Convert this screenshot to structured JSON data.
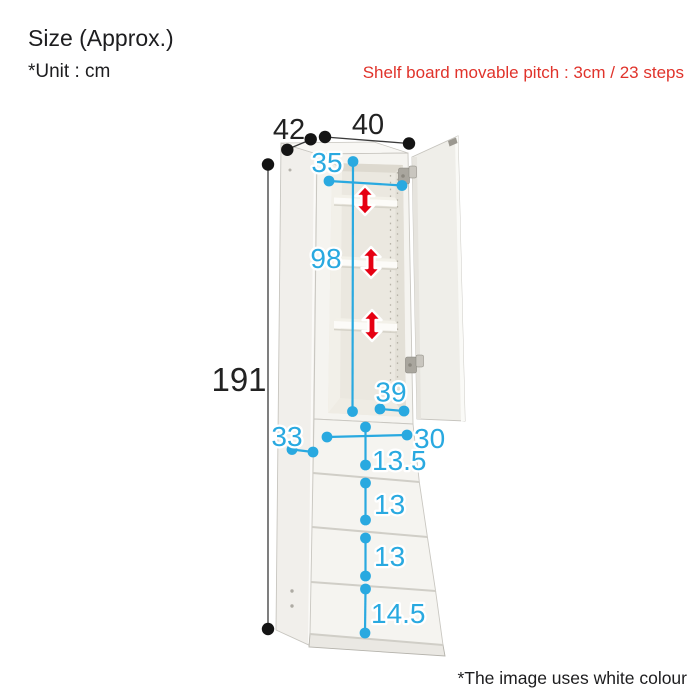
{
  "header": {
    "title": "Size (Approx.)",
    "unit_note": "*Unit : cm",
    "pitch_note": "Shelf board movable pitch : 3cm / 23 steps"
  },
  "footer": {
    "colour_note": "*The image uses white colour"
  },
  "dimensions": {
    "depth": "42",
    "width": "40",
    "height": "191",
    "inner_width": "35",
    "inner_height": "98",
    "inner_depth": "39",
    "drawer_depth": "33",
    "drawer_inner_width": "30",
    "drawer1_height": "13.5",
    "drawer2_height": "13",
    "drawer3_height": "13",
    "drawer4_height": "14.5"
  },
  "colors": {
    "dimension_blue": "#29a9e0",
    "arrow_red": "#e60012",
    "note_red": "#e0332b",
    "text_black": "#1d1d1f"
  }
}
